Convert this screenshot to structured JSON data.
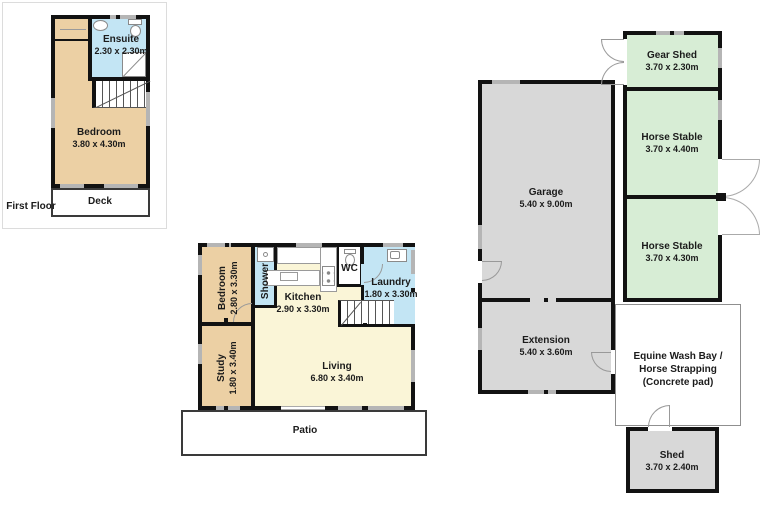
{
  "plan_title": "Residential floor plan with outbuildings",
  "first_floor_label": "First Floor",
  "rooms": {
    "ff_ensuite": {
      "name": "Ensuite",
      "dims": "2.30 x 2.30m"
    },
    "ff_bedroom": {
      "name": "Bedroom",
      "dims": "3.80 x 4.30m"
    },
    "ff_deck": {
      "name": "Deck"
    },
    "g_bedroom": {
      "name": "Bedroom",
      "dims": "2.80 x 3.30m"
    },
    "g_shower": {
      "name": "Shower"
    },
    "g_kitchen": {
      "name": "Kitchen",
      "dims": "2.90 x 3.30m"
    },
    "g_wc": {
      "name": "WC"
    },
    "g_laundry": {
      "name": "Laundry",
      "dims": "1.80 x 3.30m"
    },
    "g_study": {
      "name": "Study",
      "dims": "1.80 x 3.40m"
    },
    "g_living": {
      "name": "Living",
      "dims": "6.80 x 3.40m"
    },
    "g_patio": {
      "name": "Patio"
    },
    "garage": {
      "name": "Garage",
      "dims": "5.40 x 9.00m"
    },
    "extension": {
      "name": "Extension",
      "dims": "5.40 x 3.60m"
    },
    "gear_shed": {
      "name": "Gear Shed",
      "dims": "3.70 x 2.30m"
    },
    "horse_stable_1": {
      "name": "Horse Stable",
      "dims": "3.70 x 4.40m"
    },
    "horse_stable_2": {
      "name": "Horse Stable",
      "dims": "3.70 x 4.30m"
    },
    "wash_bay": {
      "line1": "Equine Wash Bay /",
      "line2": "Horse Strapping",
      "line3": "(Concrete pad)"
    },
    "shed": {
      "name": "Shed",
      "dims": "3.70 x 2.40m"
    }
  },
  "colors": {
    "bedroom_tan": "#ecd0a4",
    "wet_area_blue": "#c3e5f4",
    "living_yellow": "#faf5d7",
    "stable_green": "#d7edd5",
    "utility_gray": "#d8d8d8",
    "wall_black": "#121212",
    "window_gray": "#b5b5b5",
    "text": "#1b1b1b"
  }
}
